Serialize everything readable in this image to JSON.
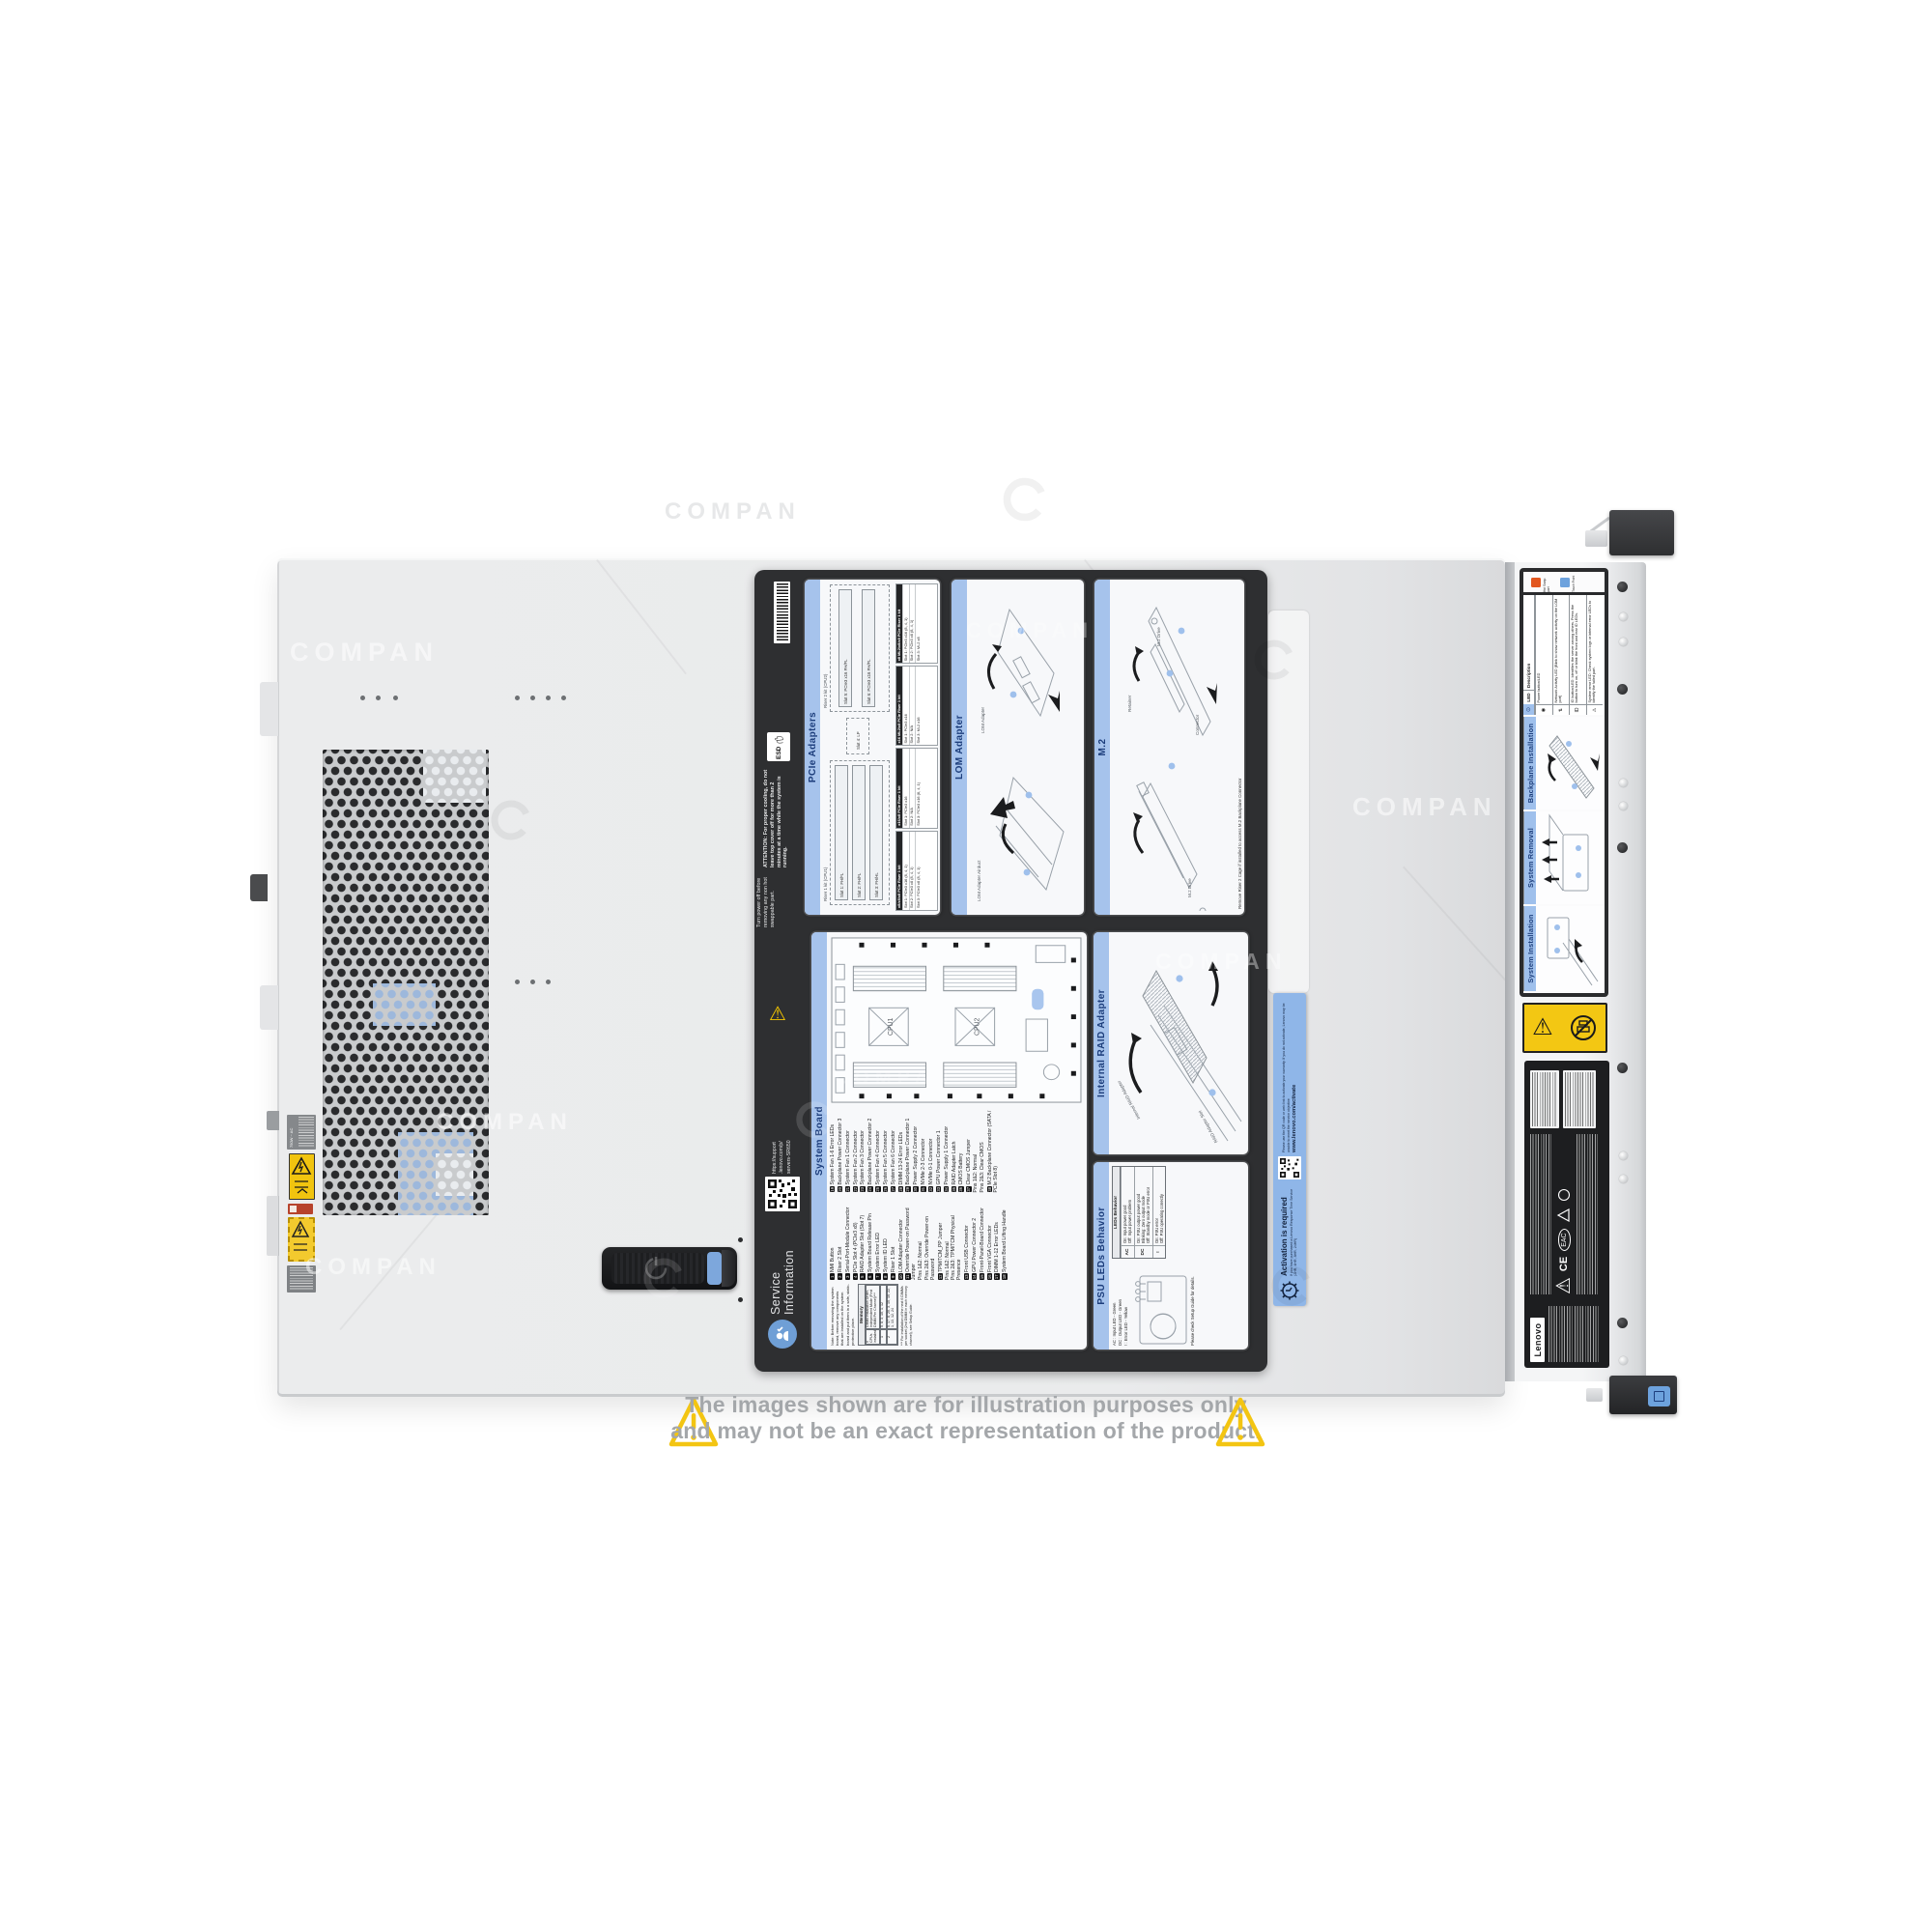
{
  "watermark": {
    "text": "COMPAN"
  },
  "disclaimer": {
    "line1": "The images shown are for illustration purposes only",
    "line2": "and may not be an exact representation of the product."
  },
  "cover": {
    "psu_rating": "750W ~ AC"
  },
  "panel": {
    "esd": "ESD",
    "attention": "ATTENTION:  For proper cooling, do not leave top cover off for more than 2 minutes at a time while the system is running.",
    "turn_power": "Turn power off before removing any non hot swappable part.",
    "qr_lines": [
      "https://support",
      ".lenovo.com/p/",
      "servers-SR650"
    ],
    "service": {
      "line1": "Service",
      "line2": "Information"
    },
    "pcie": {
      "title": "PCIe Adapters",
      "riser1": "Riser 1 kit (CPU1)",
      "riser2": "Riser 2 kit (CPU2)",
      "slots": [
        "Slot 1: FH/FL",
        "Slot 2: FH/FL",
        "Slot 3: FH/HL",
        "Slot 4: LP",
        "Slot 5: PCIe3 x16 FH/FL",
        "Slot 6: PCIe3 x16 FH/FL"
      ],
      "tables": [
        {
          "header": "x8/x8/x8 PCIe Riser 1 kit",
          "rows": [
            "Slot 1: PCIe3 x16 (8, 4, 1)",
            "Slot 2: PCIe3 x8 (8, 4, 1)",
            "Slot 3: PCIe3 x8 (8, 4, 1)"
          ]
        },
        {
          "header": "x16/x8 PCIe Riser 1 kit",
          "rows": [
            "Slot 1: PCIe3 x16",
            "Slot 2: N/A",
            "Slot 3: PCIe3 x16 (8, 4, 1)"
          ]
        },
        {
          "header": "x16 ML2/x8 PCIe Riser 1 kit",
          "rows": [
            "Slot 1: PCIe3 x16",
            "Slot 2: N/A",
            "Slot 3: ML2 x16"
          ]
        },
        {
          "header": "x8 ML2/x8/x8 PCIe Riser 1 kit",
          "rows": [
            "Slot 1: PCIe3 x16 (8, 4, 1)",
            "Slot 2: PCIe3 x8 (8, 4, 1)",
            "Slot 3: ML2 x8"
          ]
        }
      ]
    },
    "lom": {
      "title": "LOM Adapter",
      "labels": [
        "LOM Adapter Airduct",
        "LOM Adapter"
      ]
    },
    "m2": {
      "title": "M.2",
      "labels": [
        "M.2 Drive",
        "Retainer",
        "Connector",
        "M.2 Drive"
      ],
      "note": "Remove Riser 2 Cage if installed to access M.2 Backplane Connector"
    },
    "system_board": {
      "title": "System Board",
      "cpu1": "CPU1",
      "cpu2": "CPU2",
      "legend_col1": [
        {
          "n": "1",
          "t": "NMI Button"
        },
        {
          "n": "2",
          "t": "Riser 2 Slot"
        },
        {
          "n": "3",
          "t": "Serial-Port-Module Connector"
        },
        {
          "n": "4",
          "t": "PCIe Slot 4 (PCIe3 x8)"
        },
        {
          "n": "5",
          "t": "RAID Adapter Slot (Slot 7)"
        },
        {
          "n": "6",
          "t": "System Board Release Pin"
        },
        {
          "n": "7",
          "t": "System Error LED"
        },
        {
          "n": "8",
          "t": "System ID LED"
        },
        {
          "n": "9",
          "t": "Riser 1 Slot"
        },
        {
          "n": "10",
          "t": "LOM Adapter Connector"
        },
        {
          "n": "11",
          "t": "Override Power-on Password Jumper"
        },
        {
          "n": "",
          "t": "Pins 1&2: Normal"
        },
        {
          "n": "",
          "t": "Pins 2&3: Override Power-on Password"
        },
        {
          "n": "12",
          "t": "TPM/TCM_PP Jumper"
        },
        {
          "n": "",
          "t": "Pins 1&2: Normal"
        },
        {
          "n": "",
          "t": "Pins 2&3: TPM/TCM Physical Presence"
        },
        {
          "n": "13",
          "t": "Front USB Connector"
        },
        {
          "n": "14",
          "t": "GPU Power Connector 2"
        },
        {
          "n": "15",
          "t": "Front-Panel-Board Connector"
        },
        {
          "n": "16",
          "t": "Front VGA Connector"
        },
        {
          "n": "17",
          "t": "DIMM 1-12 Error LEDs"
        },
        {
          "n": "18",
          "t": "System Board Lifting Handle"
        }
      ],
      "legend_col2": [
        {
          "n": "19",
          "t": "System Fan 1-6 Error LEDs"
        },
        {
          "n": "20",
          "t": "Backplane Power Connector 3"
        },
        {
          "n": "21",
          "t": "System Fan 1 Connector"
        },
        {
          "n": "22",
          "t": "System Fan 2 Connector"
        },
        {
          "n": "23",
          "t": "System Fan 3 Connector"
        },
        {
          "n": "24",
          "t": "Backplane Power Connector 2"
        },
        {
          "n": "25",
          "t": "System Fan 4 Connector"
        },
        {
          "n": "26",
          "t": "System Fan 5 Connector"
        },
        {
          "n": "27",
          "t": "System Fan 6 Connector"
        },
        {
          "n": "28",
          "t": "DIMM 13-24 Error LEDs"
        },
        {
          "n": "29",
          "t": "Backplane Power Connector 1"
        },
        {
          "n": "30",
          "t": "Power Supply 2 Connector"
        },
        {
          "n": "31",
          "t": "NVMe 2-3 Connector"
        },
        {
          "n": "32",
          "t": "NVMe 0-1 Connector"
        },
        {
          "n": "33",
          "t": "GPU Power Connector 1"
        },
        {
          "n": "34",
          "t": "Power Supply 1 Connector"
        },
        {
          "n": "35",
          "t": "RAID Adapter Latch"
        },
        {
          "n": "36",
          "t": "CMOS Battery"
        },
        {
          "n": "37",
          "t": "Clear CMOS Jumper"
        },
        {
          "n": "",
          "t": "Pins 1&2: Normal"
        },
        {
          "n": "",
          "t": "Pins 2&3: Clear CMOS"
        },
        {
          "n": "38",
          "t": "M.2 Backplane Connector (SATA / PCIe Slot 8)"
        }
      ],
      "note": "Note: Before removing the system board, remove any components that are installed on the system board and put them in a safe, static-protective place.",
      "memory": {
        "title": "Memory",
        "col1": "# CPUs installed",
        "col2": "DIMM Installation Order-Independent Mode (First DIMM Per Channel)***",
        "rows": [
          [
            "1",
            "5, 8, 3, 10, 1, 12"
          ],
          [
            "2",
            "5, 17, 8, 20, 3, 15, 10, 22, 1, 13, 12, 24"
          ]
        ],
        "footnote": "*** For installation of the next 6 DIMMs per socket (2nd DIMM in each memory channel), see Setup Guide."
      }
    },
    "raid": {
      "title": "Internal RAID Adapter",
      "labels": [
        "Internal RAID Adapter",
        "RAID Adapter Slot"
      ]
    },
    "psu": {
      "title": "PSU LEDs Behavior",
      "led_labels": [
        "AC : Input LED - Green",
        "DC : Output LED - Green",
        "!  : Error LED - Yellow"
      ],
      "check_note": "Please check Setup Guide for details.",
      "table_title": "LEDs Behavior",
      "rows": [
        {
          "led": "AC",
          "desc": "On: Input power good\nOff: Input power problem"
        },
        {
          "led": "DC",
          "desc": "On: PSU output power good\nBlinking: Zero output mode\nOff: Standby mode or PSU error"
        },
        {
          "led": "!",
          "desc": "On: PSU error\nOff: PSU operating correctly"
        }
      ]
    }
  },
  "front": {
    "hot_swap": {
      "orange": "Hot Swap part",
      "blue": "Touch Point"
    },
    "led_table": {
      "header_led": "LED",
      "header_desc": "Description",
      "rows": [
        {
          "glyph": "◉",
          "text": "Power button/LED"
        },
        {
          "glyph": "⇅",
          "text": "Network Activity LED (Blink to show network activity on the LOM port)"
        },
        {
          "glyph": "ID",
          "text": "ID button/LED: Identifies the server among others. Press the button to turn on, off or blink the front and rear ID LEDs."
        },
        {
          "glyph": "⚠",
          "text": "System error LED: Check system logs or internal error LEDs to identify the failed part."
        }
      ]
    },
    "sections": [
      "Backplane Installation",
      "System Removal",
      "System Installation"
    ],
    "activation": {
      "title": "Activation is required",
      "intro": "If you have purchased a Lenovo Response Time Service (2HR, 4HR, 8HR, 24HR)",
      "body": "Please use the QR code or web link to activate your warranty. If you do not activate, Lenovo may be unable to meet the service objective",
      "url": "www.lenovo.com/activate"
    },
    "regulatory": {
      "brand": "Lenovo",
      "marks": [
        "CE",
        "EAC"
      ]
    }
  }
}
